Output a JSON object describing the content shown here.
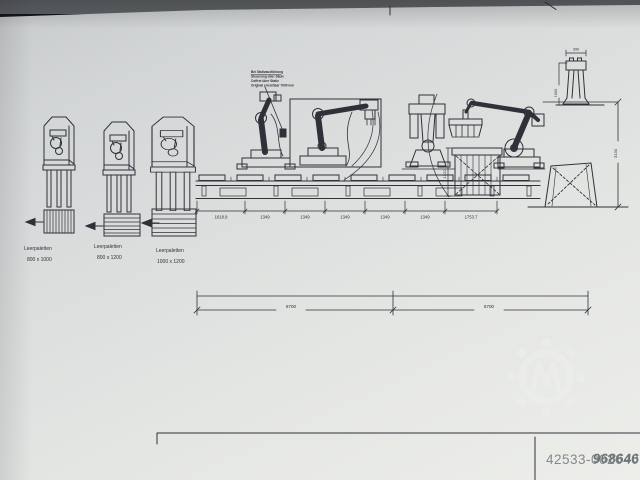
{
  "drawing": {
    "pallet_magazines": [
      {
        "label": "Leerpaletten",
        "size": "800 x 1000"
      },
      {
        "label": "Leerpaletten",
        "size": "800 x 1200"
      },
      {
        "label": "Leerpaletten",
        "size": "1000 x 1200"
      }
    ],
    "annotation_note": {
      "lines": [
        "Bei Stativausführung",
        "Steuerung über Säule",
        "Coffret über Stativ",
        "Original erreichbar 7000 mm"
      ]
    },
    "dims": {
      "conveyor_segments": [
        "1618.8",
        "1349",
        "1349",
        "1349",
        "1349",
        "1349",
        "1753.7"
      ],
      "overall_left": "6700",
      "overall_right": "6700",
      "stack_height": "1222",
      "post_width": "390",
      "post_height": "1000",
      "total_height": "3130"
    },
    "watermark": {
      "number": "42533-0026407",
      "overlay_digits": "9686467",
      "logo": "gear-emblem-watermark"
    },
    "colors": {
      "ink": "#2e3138",
      "paper": "#dcdedd",
      "watermark_text": "#83888b"
    }
  }
}
